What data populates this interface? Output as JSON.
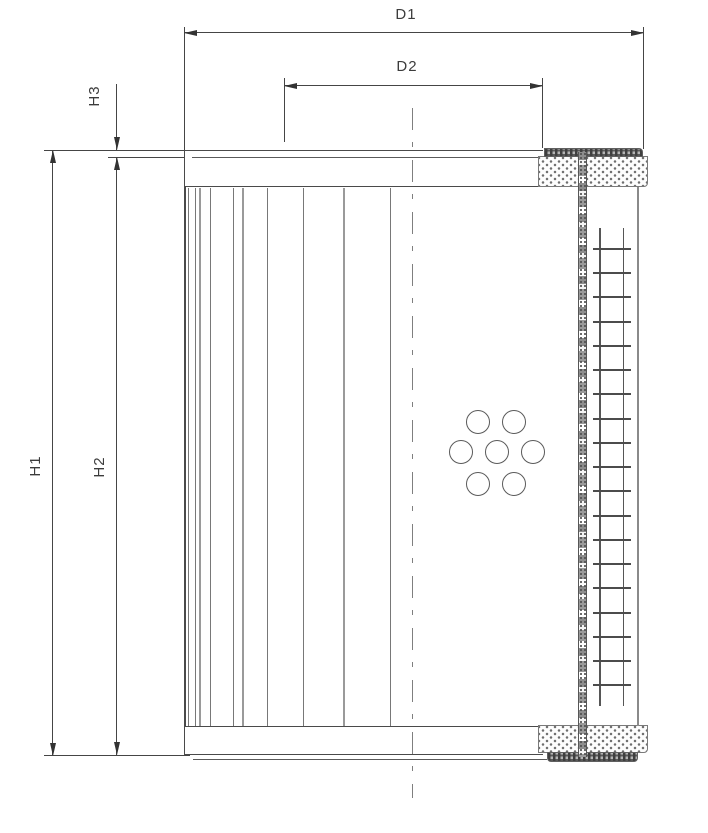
{
  "drawing": {
    "background": "#ffffff",
    "line_color": "#3f3f3f",
    "labels": {
      "d1": "D1",
      "d2": "D2",
      "h1": "H1",
      "h2": "H2",
      "h3": "H3"
    }
  }
}
